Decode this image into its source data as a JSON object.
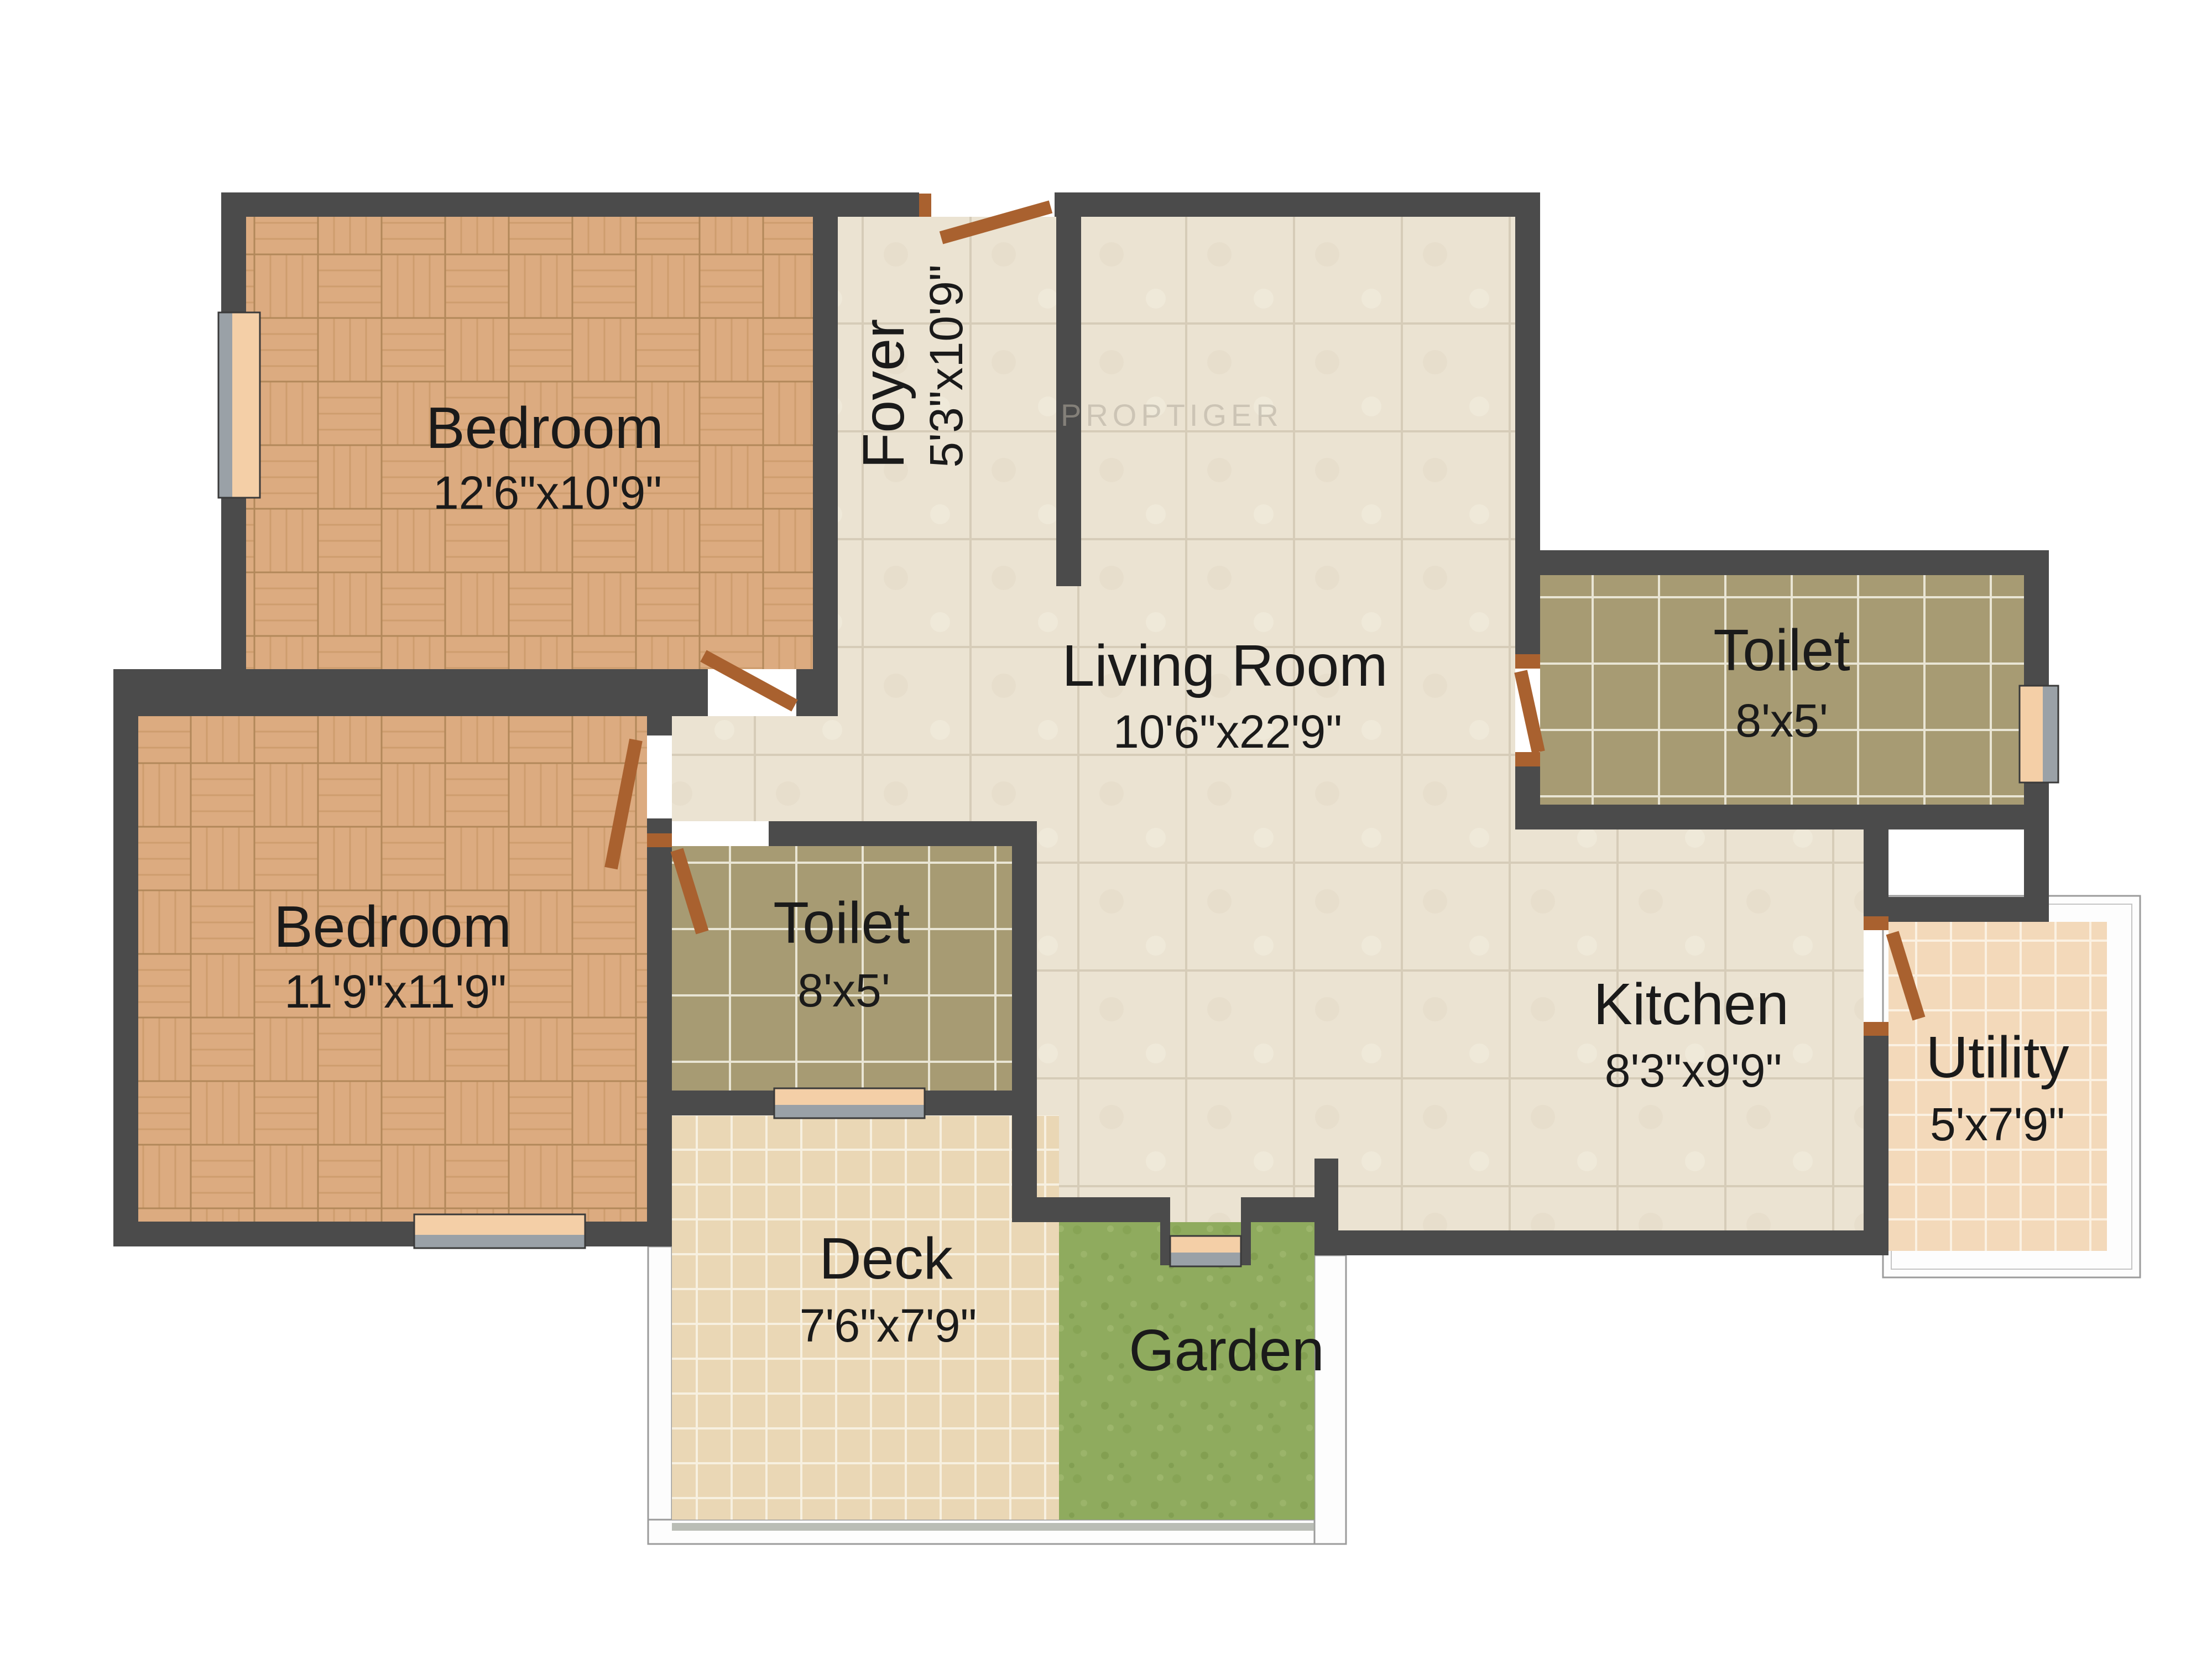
{
  "watermark": "PROPTIGER",
  "rooms": {
    "bedroom_top": {
      "name": "Bedroom",
      "dims": "12'6\"x10'9\""
    },
    "foyer": {
      "name": "Foyer",
      "dims": "5'3\"x10'9\""
    },
    "living_room": {
      "name": "Living Room",
      "dims": "10'6\"x22'9\""
    },
    "toilet_right": {
      "name": "Toilet",
      "dims": "8'x5'"
    },
    "bedroom_left": {
      "name": "Bedroom",
      "dims": "11'9\"x11'9\""
    },
    "toilet_middle": {
      "name": "Toilet",
      "dims": "8'x5'"
    },
    "kitchen": {
      "name": "Kitchen",
      "dims": "8'3\"x9'9\""
    },
    "utility": {
      "name": "Utility",
      "dims": "5'x7'9\""
    },
    "deck": {
      "name": "Deck",
      "dims": "7'6\"x7'9\""
    },
    "garden": {
      "name": "Garden"
    }
  },
  "colors": {
    "wall": "#4b4b4b",
    "wood_floor": "#dcab80",
    "living_tile": "#ebe3d2",
    "toilet_tile": "#a79b73",
    "deck_tile": "#ead7b5",
    "utility_tile": "#f3d9ba",
    "grass": "#8fab5e",
    "window": "#f4cfa7",
    "window_sill": "#9aa1a7",
    "door": "#a9612f",
    "railing": "#9b9b9b"
  }
}
